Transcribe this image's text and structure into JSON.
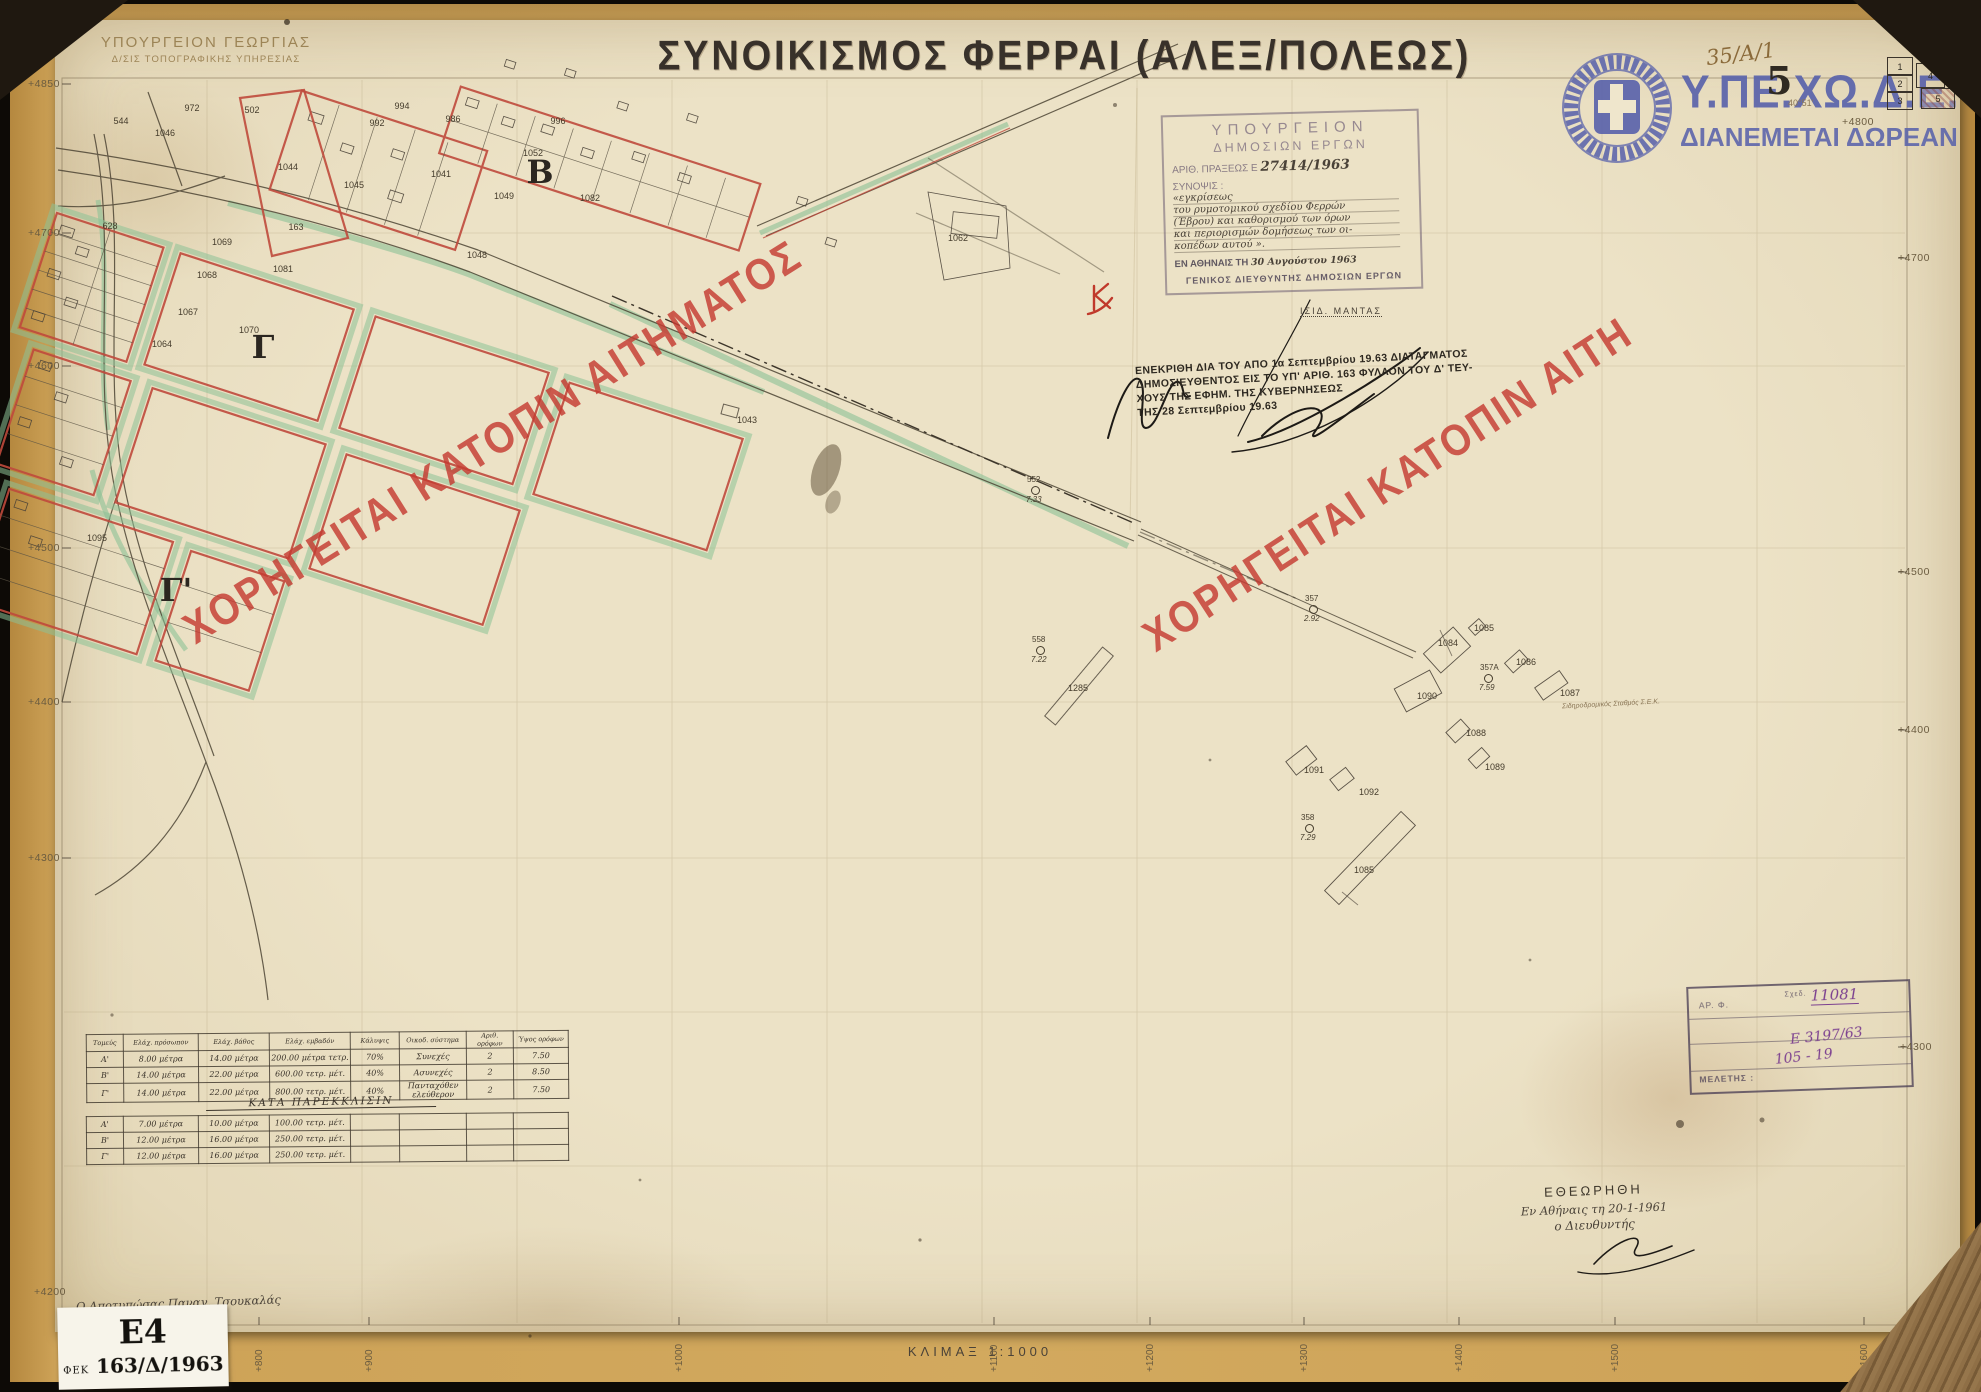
{
  "header": {
    "ministry_line1": "ΥΠΟΥΡΓΕΙΟΝ ΓΕΩΡΓΙΑΣ",
    "ministry_line2": "Δ/ΣΙΣ ΤΟΠΟΓΡΑΦΙΚΗΣ ΥΠΗΡΕΣΙΑΣ",
    "title": "ΣΥΝΟΙΚΙΣΜΟΣ ΦΕΡΡΑΙ (ΑΛΕΞ/ΠΟΛΕΩΣ)"
  },
  "brand": {
    "org": "Υ.ΠΕ.ΧΩ.Δ.Ε.",
    "free_text": "ΔΙΑΝΕΜΕΤΑΙ ΔΩΡΕΑΝ",
    "logo_color": "#5a63ab"
  },
  "sheet_refs": {
    "handwritten_ref": "35/Α/1",
    "sheet_number": "5",
    "latitude": "40°51'",
    "index_cells": {
      "c1": "1",
      "c2": "2",
      "c3": "3",
      "c4": "4",
      "c5": "5"
    }
  },
  "watermark": {
    "text_full": "ΧΟΡΗΓΕΙΤΑΙ ΚΑΤΟΠΙΝ ΑΙΤΗΜΑΤΟΣ",
    "text_truncated": "ΧΟΡΗΓΕΙΤΑΙ ΚΑΤΟΠΙΝ ΑΙΤΗ",
    "color": "#c53b31"
  },
  "approval_stamp": {
    "line1": "ΥΠΟΥΡΓΕΙΟΝ",
    "line2": "ΔΗΜΟΣΙΩΝ ΕΡΓΩΝ",
    "number_label": "ΑΡΙΘ. ΠΡΑΞΕΩΣ Ε",
    "number_value": "27414/1963",
    "summary_label": "ΣΥΝΟΨΙΣ :",
    "summary_lines": [
      "«εγκρίσεως",
      "του ρυμοτομικού σχεδίου Φερρών",
      "(Έβρου) και καθορισμού των όρων",
      "και περιορισμών δομήσεως των οι-",
      "κοπέδων αυτού »."
    ],
    "date_label": "ΕΝ ΑΘΗΝΑΙΣ ΤΗ",
    "date_value": "30 Αυγούστου 1963",
    "director_line": "ΓΕΝΙΚΟΣ ΔΙΕΥΘΥΝΤΗΣ ΔΗΜΟΣΙΩΝ ΕΡΓΩΝ",
    "signatory": "ΙΣΙΔ. ΜΑΝΤΑΣ"
  },
  "decree_note": {
    "lines": [
      "ΕΝΕΚΡΙΘΗ ΔΙΑ ΤΟΥ ΑΠΟ 1α Σεπτεμβρίου 19.63 ΔΙΑΤΑΓΜΑΤΟΣ",
      "ΔΗΜΟΣΙΕΥΘΕΝΤΟΣ ΕΙΣ ΤΟ ΥΠ' ΑΡΙΘ. 163 ΦΥΛΛΟΝ ΤΟΥ Δ' ΤΕΥ-",
      "ΧΟΥΣ ΤΗΣ ΕΦΗΜ. ΤΗΣ ΚΥΒΕΡΝΗΣΕΩΣ",
      "ΤΗΣ 28 Σεπτεμβρίου 19.63"
    ]
  },
  "review_block": {
    "title": "ΕΘΕΩΡΗΘΗ",
    "place_line": "Εν Αθήναις τη 20-1-1961",
    "role": "ο Διευθυντής"
  },
  "registry_stamp": {
    "label_file": "ΑΡ. Φ.",
    "label_faint": "Σχεδ.",
    "label_study": "ΜΕΛΕΤΗΣ :",
    "hw_number": "11081",
    "hw_ref": "Ε 3197/63",
    "hw_pages": "105 - 19"
  },
  "footer": {
    "scale": "ΚΛΙΜΑΞ 1:1000",
    "surveyor": "Ο Αποτυπώσας Παναγ. Τσουκαλάς",
    "initials": "Μ. Σιών",
    "label_code": "Ε4",
    "label_fek_prefix": "ΦΕΚ",
    "label_fek_value": "163/Δ/1963"
  },
  "building_terms_table": {
    "headers": [
      "Τομεύς",
      "Ελάχ. πρόσωπον",
      "Ελάχ. βάθος",
      "Ελάχ. εμβαδόν",
      "Κάλυψις",
      "Οικοδ. σύστημα",
      "Αριθ. ορόφων",
      "Ύψος ορόφων"
    ],
    "rows": [
      [
        "Α'",
        "8.00 μέτρα",
        "14.00 μέτρα",
        "200.00 μέτρα τετρ.",
        "70%",
        "Συνεχές",
        "2",
        "7.50"
      ],
      [
        "Β'",
        "14.00 μέτρα",
        "22.00 μέτρα",
        "600.00 τετρ. μέτ.",
        "40%",
        "Ασυνεχές",
        "2",
        "8.50"
      ],
      [
        "Γ'",
        "14.00 μέτρα",
        "22.00 μέτρα",
        "800.00 τετρ. μέτ.",
        "40%",
        "Πανταχόθεν ελεύθερον",
        "2",
        "7.50"
      ]
    ]
  },
  "derogation_table": {
    "title": "ΚΑΤΑ ΠΑΡΕΚΚΛΙΣΙΝ",
    "rows": [
      [
        "Α'",
        "7.00 μέτρα",
        "10.00 μέτρα",
        "100.00 τετρ. μέτ.",
        "",
        "",
        "",
        ""
      ],
      [
        "Β'",
        "12.00 μέτρα",
        "16.00 μέτρα",
        "250.00 τετρ. μέτ.",
        "",
        "",
        "",
        ""
      ],
      [
        "Γ'",
        "12.00 μέτρα",
        "16.00 μέτρα",
        "250.00 τετρ. μέτ.",
        "",
        "",
        "",
        ""
      ]
    ]
  },
  "map": {
    "station_text": "Σιδηροδρομικός Σταθμός Σ.Ε.Κ.",
    "block_letters": [
      {
        "x": 540,
        "y": 172,
        "t": "Β"
      },
      {
        "x": 263,
        "y": 347,
        "t": "Γ"
      },
      {
        "x": 176,
        "y": 590,
        "t": "Γ'"
      }
    ],
    "parcel_labels": [
      {
        "x": 121,
        "y": 121,
        "t": "544"
      },
      {
        "x": 192,
        "y": 108,
        "t": "972"
      },
      {
        "x": 252,
        "y": 110,
        "t": "502"
      },
      {
        "x": 165,
        "y": 133,
        "t": "1046"
      },
      {
        "x": 288,
        "y": 167,
        "t": "1044"
      },
      {
        "x": 354,
        "y": 185,
        "t": "1045"
      },
      {
        "x": 377,
        "y": 123,
        "t": "992"
      },
      {
        "x": 402,
        "y": 106,
        "t": "994"
      },
      {
        "x": 441,
        "y": 174,
        "t": "1041"
      },
      {
        "x": 453,
        "y": 119,
        "t": "986"
      },
      {
        "x": 504,
        "y": 196,
        "t": "1049"
      },
      {
        "x": 533,
        "y": 153,
        "t": "1052"
      },
      {
        "x": 558,
        "y": 121,
        "t": "996"
      },
      {
        "x": 590,
        "y": 198,
        "t": "1082"
      },
      {
        "x": 477,
        "y": 255,
        "t": "1048"
      },
      {
        "x": 296,
        "y": 227,
        "t": "163"
      },
      {
        "x": 110,
        "y": 226,
        "t": "628"
      },
      {
        "x": 222,
        "y": 242,
        "t": "1069"
      },
      {
        "x": 207,
        "y": 275,
        "t": "1068"
      },
      {
        "x": 188,
        "y": 312,
        "t": "1067"
      },
      {
        "x": 162,
        "y": 344,
        "t": "1064"
      },
      {
        "x": 249,
        "y": 330,
        "t": "1070"
      },
      {
        "x": 283,
        "y": 269,
        "t": "1081"
      },
      {
        "x": 958,
        "y": 238,
        "t": "1062"
      },
      {
        "x": 747,
        "y": 420,
        "t": "1043"
      },
      {
        "x": 97,
        "y": 538,
        "t": "1095"
      },
      {
        "x": 1078,
        "y": 688,
        "t": "1285"
      },
      {
        "x": 1448,
        "y": 643,
        "t": "1084"
      },
      {
        "x": 1484,
        "y": 628,
        "t": "1085"
      },
      {
        "x": 1526,
        "y": 662,
        "t": "1086"
      },
      {
        "x": 1570,
        "y": 693,
        "t": "1087"
      },
      {
        "x": 1476,
        "y": 733,
        "t": "1088"
      },
      {
        "x": 1495,
        "y": 767,
        "t": "1089"
      },
      {
        "x": 1427,
        "y": 696,
        "t": "1090"
      },
      {
        "x": 1314,
        "y": 770,
        "t": "1091"
      },
      {
        "x": 1369,
        "y": 792,
        "t": "1092"
      },
      {
        "x": 1364,
        "y": 870,
        "t": "1085"
      }
    ],
    "control_points": [
      {
        "x": 1313,
        "y": 609,
        "num": "357",
        "val": "2.92"
      },
      {
        "x": 1488,
        "y": 678,
        "num": "357Α",
        "val": "7.59"
      },
      {
        "x": 1309,
        "y": 828,
        "num": "358",
        "val": "7.29"
      },
      {
        "x": 1040,
        "y": 650,
        "num": "558",
        "val": "7.22"
      },
      {
        "x": 1035,
        "y": 490,
        "num": "552",
        "val": "7.33"
      }
    ]
  },
  "grid": {
    "left": [
      {
        "x": 28,
        "y": 78,
        "t": "+4850"
      },
      {
        "x": 28,
        "y": 227,
        "t": "+4700"
      },
      {
        "x": 28,
        "y": 360,
        "t": "+4600"
      },
      {
        "x": 28,
        "y": 542,
        "t": "+4500"
      },
      {
        "x": 28,
        "y": 696,
        "t": "+4400"
      },
      {
        "x": 28,
        "y": 852,
        "t": "+4300"
      },
      {
        "x": 34,
        "y": 1286,
        "t": "+4200"
      }
    ],
    "right": [
      {
        "x": 1898,
        "y": 252,
        "t": "+4700"
      },
      {
        "x": 1898,
        "y": 566,
        "t": "+4500"
      },
      {
        "x": 1898,
        "y": 724,
        "t": "+4400"
      },
      {
        "x": 1900,
        "y": 1041,
        "t": "+4300"
      },
      {
        "x": 1842,
        "y": 116,
        "t": "+4800"
      }
    ],
    "bottom": [
      {
        "x": 80,
        "y": 1372,
        "t": "+700"
      },
      {
        "x": 254,
        "y": 1372,
        "t": "+800"
      },
      {
        "x": 364,
        "y": 1372,
        "t": "+900"
      },
      {
        "x": 674,
        "y": 1372,
        "t": "+1000"
      },
      {
        "x": 989,
        "y": 1372,
        "t": "+1100"
      },
      {
        "x": 1145,
        "y": 1372,
        "t": "+1200"
      },
      {
        "x": 1299,
        "y": 1372,
        "t": "+1300"
      },
      {
        "x": 1454,
        "y": 1372,
        "t": "+1400"
      },
      {
        "x": 1610,
        "y": 1372,
        "t": "+1500"
      },
      {
        "x": 1859,
        "y": 1372,
        "t": "+1600"
      }
    ]
  }
}
